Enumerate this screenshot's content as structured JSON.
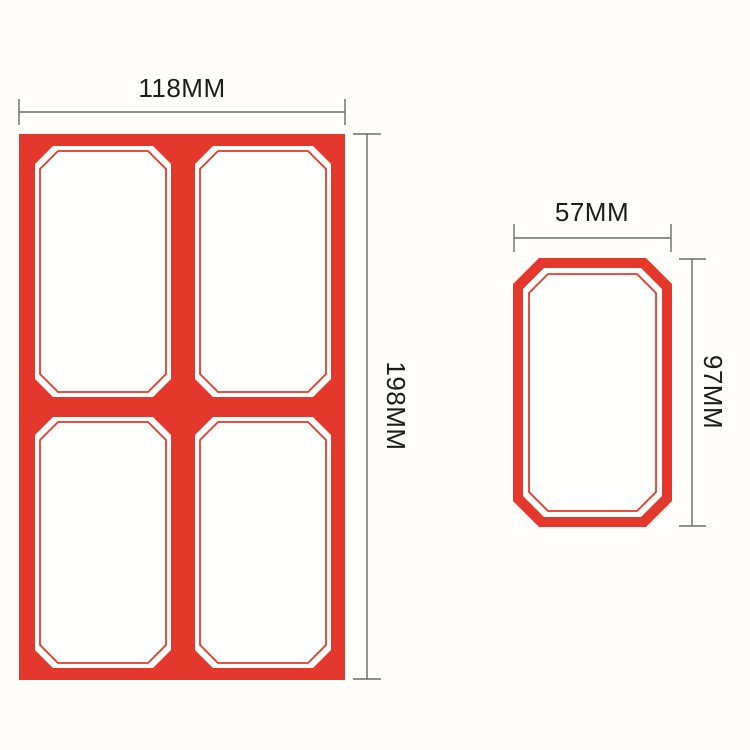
{
  "diagram": {
    "sheet": {
      "width_label": "118MM",
      "height_label": "198MM",
      "rows": 2,
      "columns": 2,
      "label_count": 4
    },
    "single_label": {
      "width_label": "57MM",
      "height_label": "97MM"
    },
    "colors": {
      "label_red": "#e5382d",
      "label_fill": "#fffffe",
      "background": "#fffefa",
      "dimension_line": "#6a6a6a",
      "dimension_text": "#1c1c1a"
    }
  }
}
